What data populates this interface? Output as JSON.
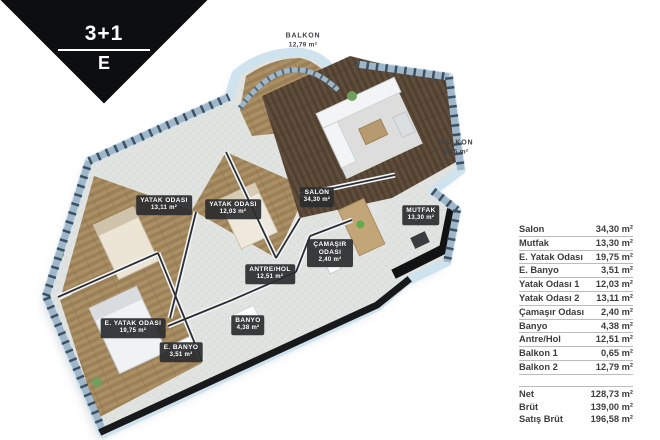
{
  "badge": {
    "top_label": "3+1",
    "bottom_label": "E"
  },
  "plan": {
    "room_labels": [
      {
        "id": "salon",
        "name": "SALON",
        "area": "34,30 m²"
      },
      {
        "id": "mutfak",
        "name": "MUTFAK",
        "area": "13,30 m²"
      },
      {
        "id": "yatak-odasi-2",
        "name": "YATAK ODASI",
        "area": "13,11 m²"
      },
      {
        "id": "yatak-odasi-1",
        "name": "YATAK ODASI",
        "area": "12,03 m²"
      },
      {
        "id": "camasir-odasi",
        "name": "ÇAMAŞIR ODASI",
        "area": "2,40 m²"
      },
      {
        "id": "antre-hol",
        "name": "ANTRE/HOL",
        "area": "12,51 m²"
      },
      {
        "id": "banyo",
        "name": "BANYO",
        "area": "4,38 m²"
      },
      {
        "id": "e-banyo",
        "name": "E. BANYO",
        "area": "3,51 m²"
      },
      {
        "id": "e-yatak-odasi",
        "name": "E. YATAK ODASI",
        "area": "19,75 m²"
      },
      {
        "id": "balkon-ust",
        "name": "BALKON",
        "area": "12,79 m²"
      },
      {
        "id": "balkon-yan",
        "name": "BALKON",
        "area": "0,65 m²"
      }
    ]
  },
  "area_table": {
    "rows": [
      {
        "label": "Salon",
        "value": "34,30 m²"
      },
      {
        "label": "Mutfak",
        "value": "13,30 m²"
      },
      {
        "label": "E. Yatak Odası",
        "value": "19,75 m²"
      },
      {
        "label": "E. Banyo",
        "value": "3,51 m²"
      },
      {
        "label": "Yatak Odası 1",
        "value": "12,03 m²"
      },
      {
        "label": "Yatak Odası 2",
        "value": "13,11 m²"
      },
      {
        "label": "Çamaşır Odası",
        "value": "2,40 m²"
      },
      {
        "label": "Banyo",
        "value": "4,38 m²"
      },
      {
        "label": "Antre/Hol",
        "value": "12,51 m²"
      },
      {
        "label": "Balkon 1",
        "value": "0,65 m²"
      },
      {
        "label": "Balkon 2",
        "value": "12,79 m²"
      }
    ],
    "summary": [
      {
        "label": "Net",
        "value": "128,73 m²"
      },
      {
        "label": "Brüt",
        "value": "139,00 m²"
      },
      {
        "label": "Satış Brüt",
        "value": "196,58 m²"
      }
    ]
  },
  "colors": {
    "ribbon": "#0d0e0f",
    "outer_wall": "#cfe3ef",
    "glass": "#9fb7c8",
    "window_frame": "#3c4f63",
    "wood_bedroom": "#a98e63",
    "wood_salon": "#5d4b3c",
    "tile": "#e0e3e0",
    "dark_wall": "#18191b",
    "label_badge": "#2c2d2f",
    "table_text": "#3c3c3c"
  }
}
